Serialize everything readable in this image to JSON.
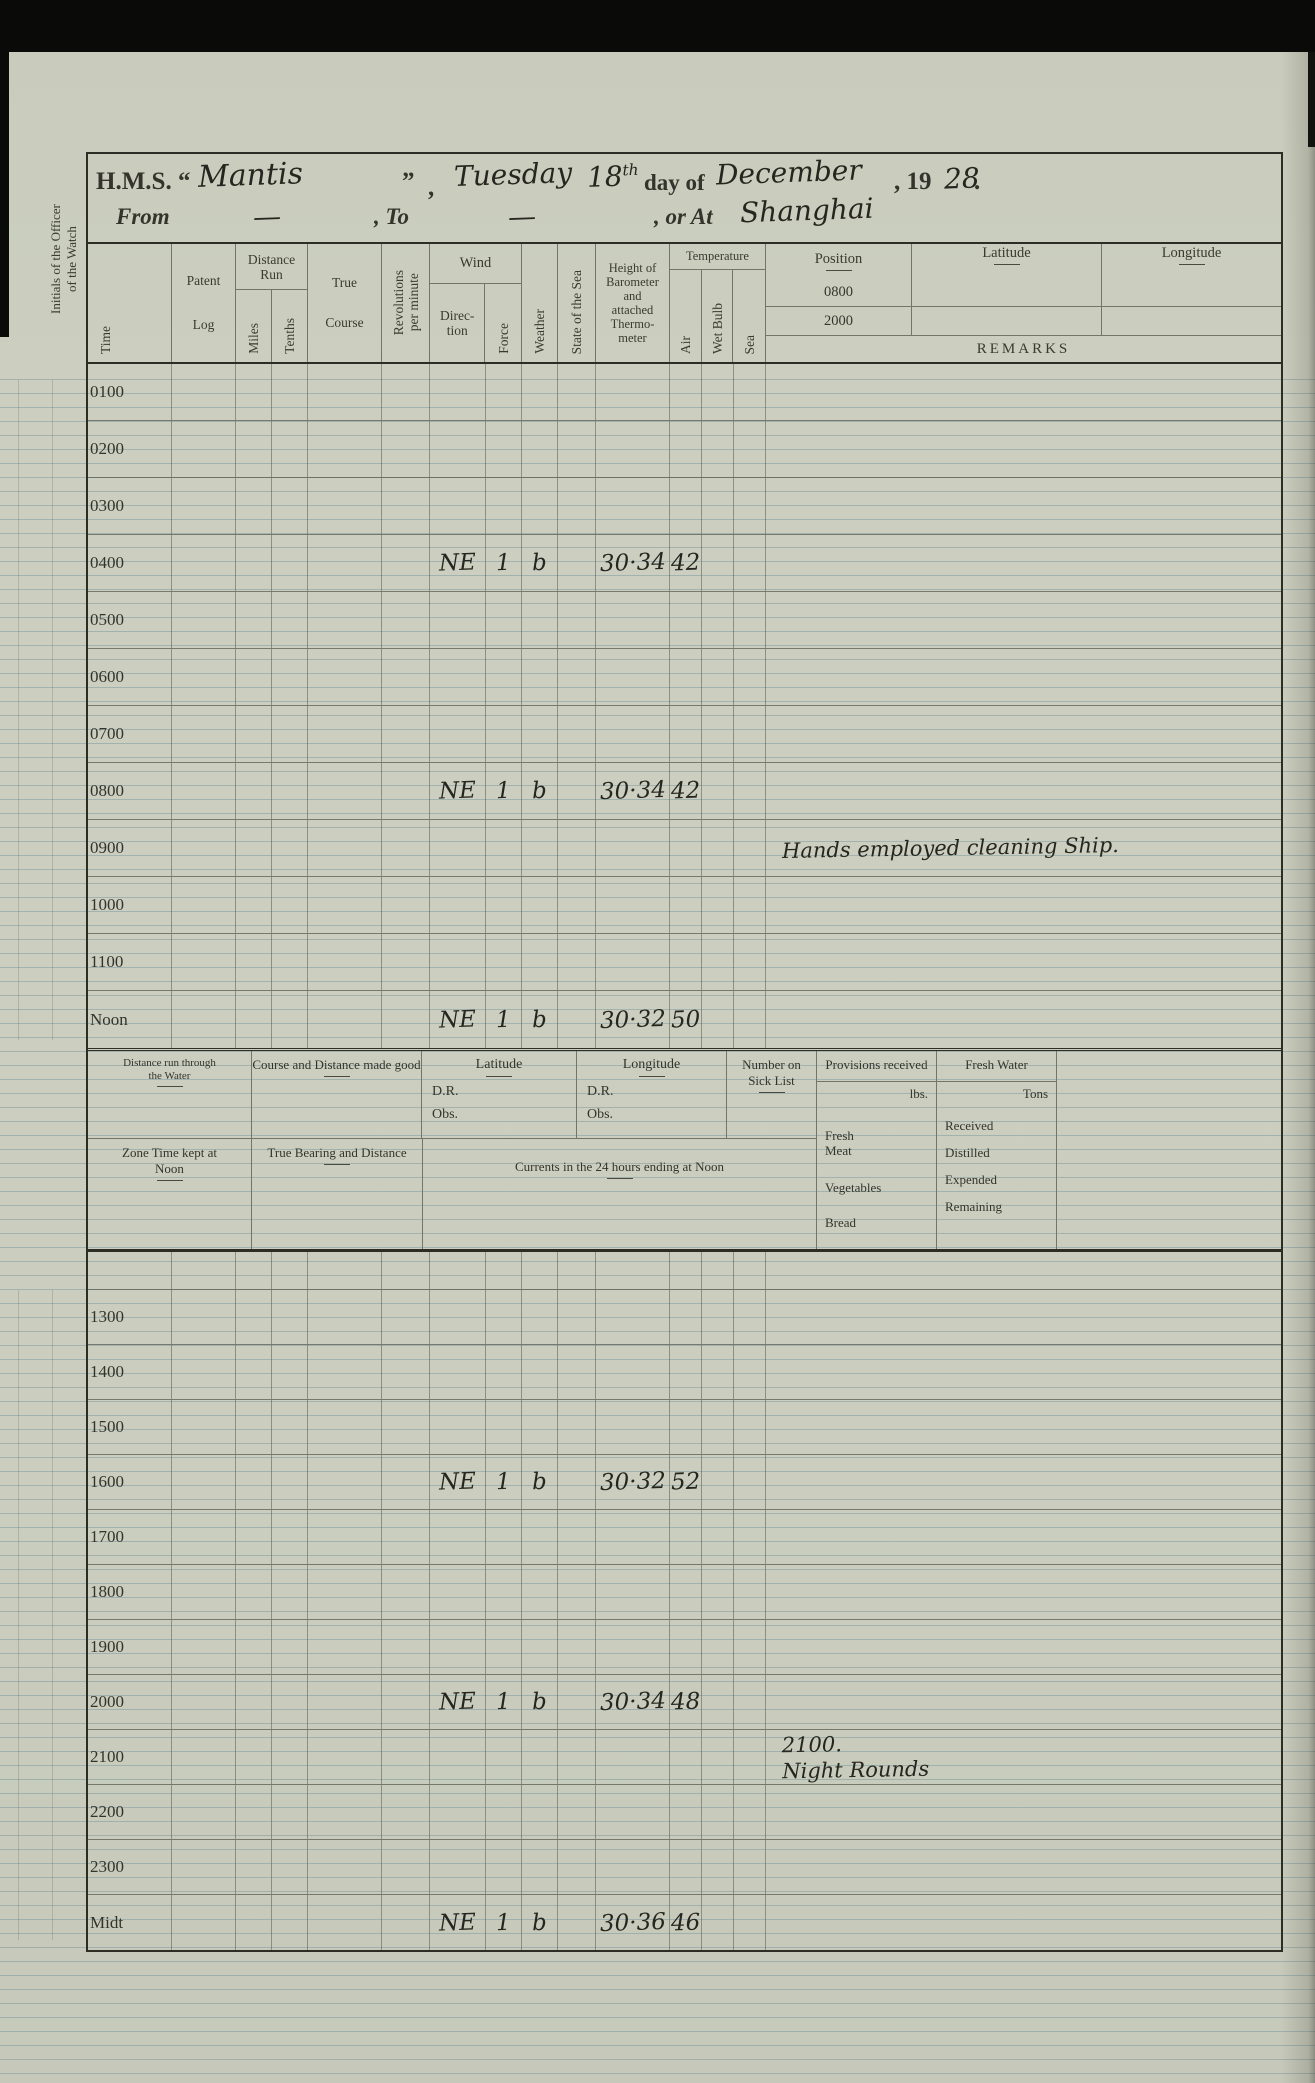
{
  "colors": {
    "paper": "#cccfc0",
    "printed_ink": "#34342c",
    "handwriting_ink": "#26251f",
    "ruled_line_blue": "#688a98",
    "scan_border": "#0a0a08"
  },
  "margin": {
    "officer_note": "Initials of the Officer\nof the Watch"
  },
  "header": {
    "hms": "H.M.S. “",
    "ship_name": "Mantis",
    "close_quote": "”",
    "comma": ",",
    "weekday": "Tuesday",
    "day": "18",
    "day_suffix": "th",
    "day_of": "day of",
    "month": "December",
    "year_prefix": ", 19",
    "year_hw": "28",
    "period": ".",
    "from_label": "From",
    "from_value": "—",
    "to_label": ",  To",
    "to_value": "—",
    "at_label": ",  or At",
    "at_value": "Shanghai"
  },
  "table_header": {
    "time": "Time",
    "patent_log": "Patent\n\nLog",
    "distance_run": "Distance\nRun",
    "miles": "Miles",
    "tenths": "Tenths",
    "true_course": "True\n\nCourse",
    "revolutions": "Revolutions\nper minute",
    "wind": "Wind",
    "direction": "Direc-\ntion",
    "force": "Force",
    "weather": "Weather",
    "state_of_sea": "State of the Sea",
    "barometer": "Height of\nBarometer\nand\nattached\nThermo-\nmeter",
    "temperature": "Temperature",
    "air": "Air",
    "wet_bulb": "Wet Bulb",
    "sea": "Sea",
    "position": "Position",
    "position_time_1": "0800",
    "position_time_2": "2000",
    "latitude": "Latitude",
    "longitude": "Longitude",
    "remarks": "REMARKS"
  },
  "morning_rows": [
    {
      "time": "0100",
      "dir": "",
      "force": "",
      "weather": "",
      "baro": "",
      "air": "",
      "remark": ""
    },
    {
      "time": "0200",
      "dir": "",
      "force": "",
      "weather": "",
      "baro": "",
      "air": "",
      "remark": ""
    },
    {
      "time": "0300",
      "dir": "",
      "force": "",
      "weather": "",
      "baro": "",
      "air": "",
      "remark": ""
    },
    {
      "time": "0400",
      "dir": "NE",
      "force": "1",
      "weather": "b",
      "baro": "30·34",
      "air": "42",
      "remark": ""
    },
    {
      "time": "0500",
      "dir": "",
      "force": "",
      "weather": "",
      "baro": "",
      "air": "",
      "remark": ""
    },
    {
      "time": "0600",
      "dir": "",
      "force": "",
      "weather": "",
      "baro": "",
      "air": "",
      "remark": ""
    },
    {
      "time": "0700",
      "dir": "",
      "force": "",
      "weather": "",
      "baro": "",
      "air": "",
      "remark": ""
    },
    {
      "time": "0800",
      "dir": "NE",
      "force": "1",
      "weather": "b",
      "baro": "30·34",
      "air": "42",
      "remark": ""
    },
    {
      "time": "0900",
      "dir": "",
      "force": "",
      "weather": "",
      "baro": "",
      "air": "",
      "remark": "Hands employed cleaning Ship."
    },
    {
      "time": "1000",
      "dir": "",
      "force": "",
      "weather": "",
      "baro": "",
      "air": "",
      "remark": ""
    },
    {
      "time": "1100",
      "dir": "",
      "force": "",
      "weather": "",
      "baro": "",
      "air": "",
      "remark": ""
    },
    {
      "time": "Noon",
      "dir": "NE",
      "force": "1",
      "weather": "b",
      "baro": "30·32",
      "air": "50",
      "remark": ""
    }
  ],
  "afternoon_rows": [
    {
      "time": "1300",
      "dir": "",
      "force": "",
      "weather": "",
      "baro": "",
      "air": "",
      "remark": ""
    },
    {
      "time": "1400",
      "dir": "",
      "force": "",
      "weather": "",
      "baro": "",
      "air": "",
      "remark": ""
    },
    {
      "time": "1500",
      "dir": "",
      "force": "",
      "weather": "",
      "baro": "",
      "air": "",
      "remark": ""
    },
    {
      "time": "1600",
      "dir": "NE",
      "force": "1",
      "weather": "b",
      "baro": "30·32",
      "air": "52",
      "remark": ""
    },
    {
      "time": "1700",
      "dir": "",
      "force": "",
      "weather": "",
      "baro": "",
      "air": "",
      "remark": ""
    },
    {
      "time": "1800",
      "dir": "",
      "force": "",
      "weather": "",
      "baro": "",
      "air": "",
      "remark": ""
    },
    {
      "time": "1900",
      "dir": "",
      "force": "",
      "weather": "",
      "baro": "",
      "air": "",
      "remark": ""
    },
    {
      "time": "2000",
      "dir": "NE",
      "force": "1",
      "weather": "b",
      "baro": "30·34",
      "air": "48",
      "remark": ""
    },
    {
      "time": "2100",
      "dir": "",
      "force": "",
      "weather": "",
      "baro": "",
      "air": "",
      "remark": "2100.\nNight Rounds"
    },
    {
      "time": "2200",
      "dir": "",
      "force": "",
      "weather": "",
      "baro": "",
      "air": "",
      "remark": ""
    },
    {
      "time": "2300",
      "dir": "",
      "force": "",
      "weather": "",
      "baro": "",
      "air": "",
      "remark": ""
    },
    {
      "time": "Midt",
      "dir": "NE",
      "force": "1",
      "weather": "b",
      "baro": "30·36",
      "air": "46",
      "remark": ""
    }
  ],
  "summary": {
    "distance_water": "Distance run through\nthe Water",
    "course_distance": "Course and Distance made good",
    "latitude": "Latitude",
    "longitude": "Longitude",
    "dr": "D.R.",
    "obs": "Obs.",
    "sick_list": "Number on\nSick List",
    "provisions": "Provisions received",
    "lbs": "lbs.",
    "fresh_meat": "Fresh\nMeat",
    "vegetables": "Vegetables",
    "bread": "Bread",
    "fresh_water": "Fresh Water",
    "tons": "Tons",
    "received": "Received",
    "distilled": "Distilled",
    "expended": "Expended",
    "remaining": "Remaining",
    "zone_time": "Zone Time kept at\nNoon",
    "true_bearing": "True Bearing and Distance",
    "currents": "Currents in the 24 hours ending at Noon"
  }
}
